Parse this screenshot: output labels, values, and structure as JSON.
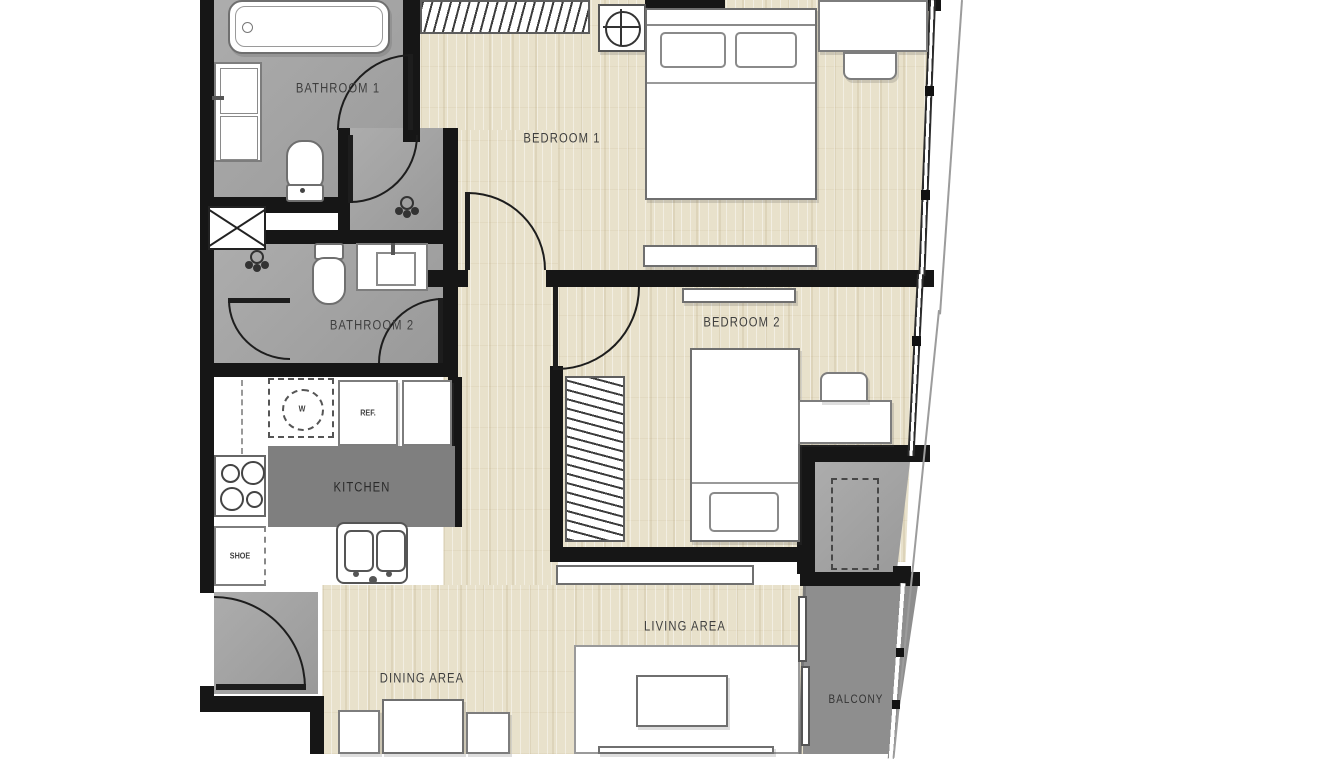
{
  "plan": {
    "type": "apartment-floor-plan-2-bedroom",
    "rooms": {
      "bathroom1": {
        "label": "BATHROOM 1"
      },
      "bedroom1": {
        "label": "BEDROOM 1"
      },
      "bathroom2": {
        "label": "BATHROOM 2"
      },
      "bedroom2": {
        "label": "BEDROOM 2"
      },
      "kitchen": {
        "label": "KITCHEN"
      },
      "dining": {
        "label": "DINING AREA"
      },
      "living": {
        "label": "LIVING AREA"
      },
      "balcony": {
        "label": "BALCONY"
      }
    },
    "appliances": {
      "refrigerator_label": "REF.",
      "washer_label": "W",
      "shoe_cabinet_label": "SHOE"
    },
    "fixtures": [
      "bathtub",
      "toilet",
      "vanity-sink",
      "shower",
      "duct-shaft",
      "washing-machine",
      "refrigerator",
      "stove",
      "kitchen-sink",
      "shoe-cabinet",
      "double-bed",
      "single-bed",
      "wardrobe",
      "desk",
      "chair",
      "bench",
      "dining-table",
      "coffee-table",
      "rug",
      "air-conditioner",
      "condenser-unit",
      "sliding-door",
      "entrance-door",
      "window"
    ],
    "colors": {
      "wall": "#161616",
      "wet_room_floor": "#a3a3a3",
      "wood_floor": "#e8e1cb",
      "balcony_floor": "#8e8e8e",
      "kitchen_island": "#7f7f7f",
      "background": "#ffffff"
    }
  }
}
